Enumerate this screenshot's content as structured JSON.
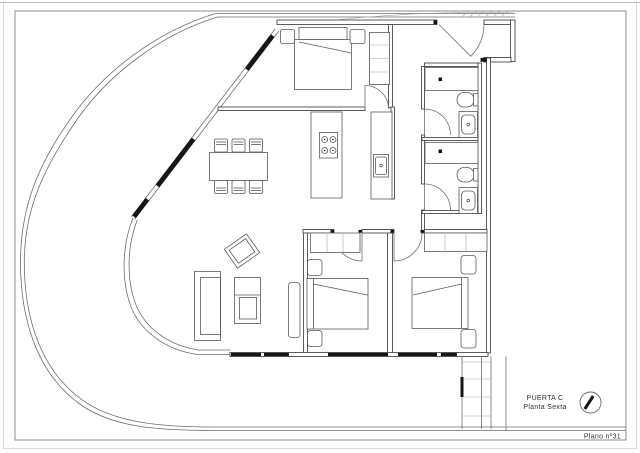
{
  "title_block": {
    "door": "PUERTA C",
    "floor": "Planta Sexta",
    "plan_number": "Plano nº31"
  },
  "north_arrow": {
    "icon": "north-arrow"
  },
  "colors": {
    "ink": "#4a4a4a",
    "wall_black": "#161616",
    "paper": "#ffffff",
    "frame": "#8c8c8c",
    "text": "#333333"
  }
}
